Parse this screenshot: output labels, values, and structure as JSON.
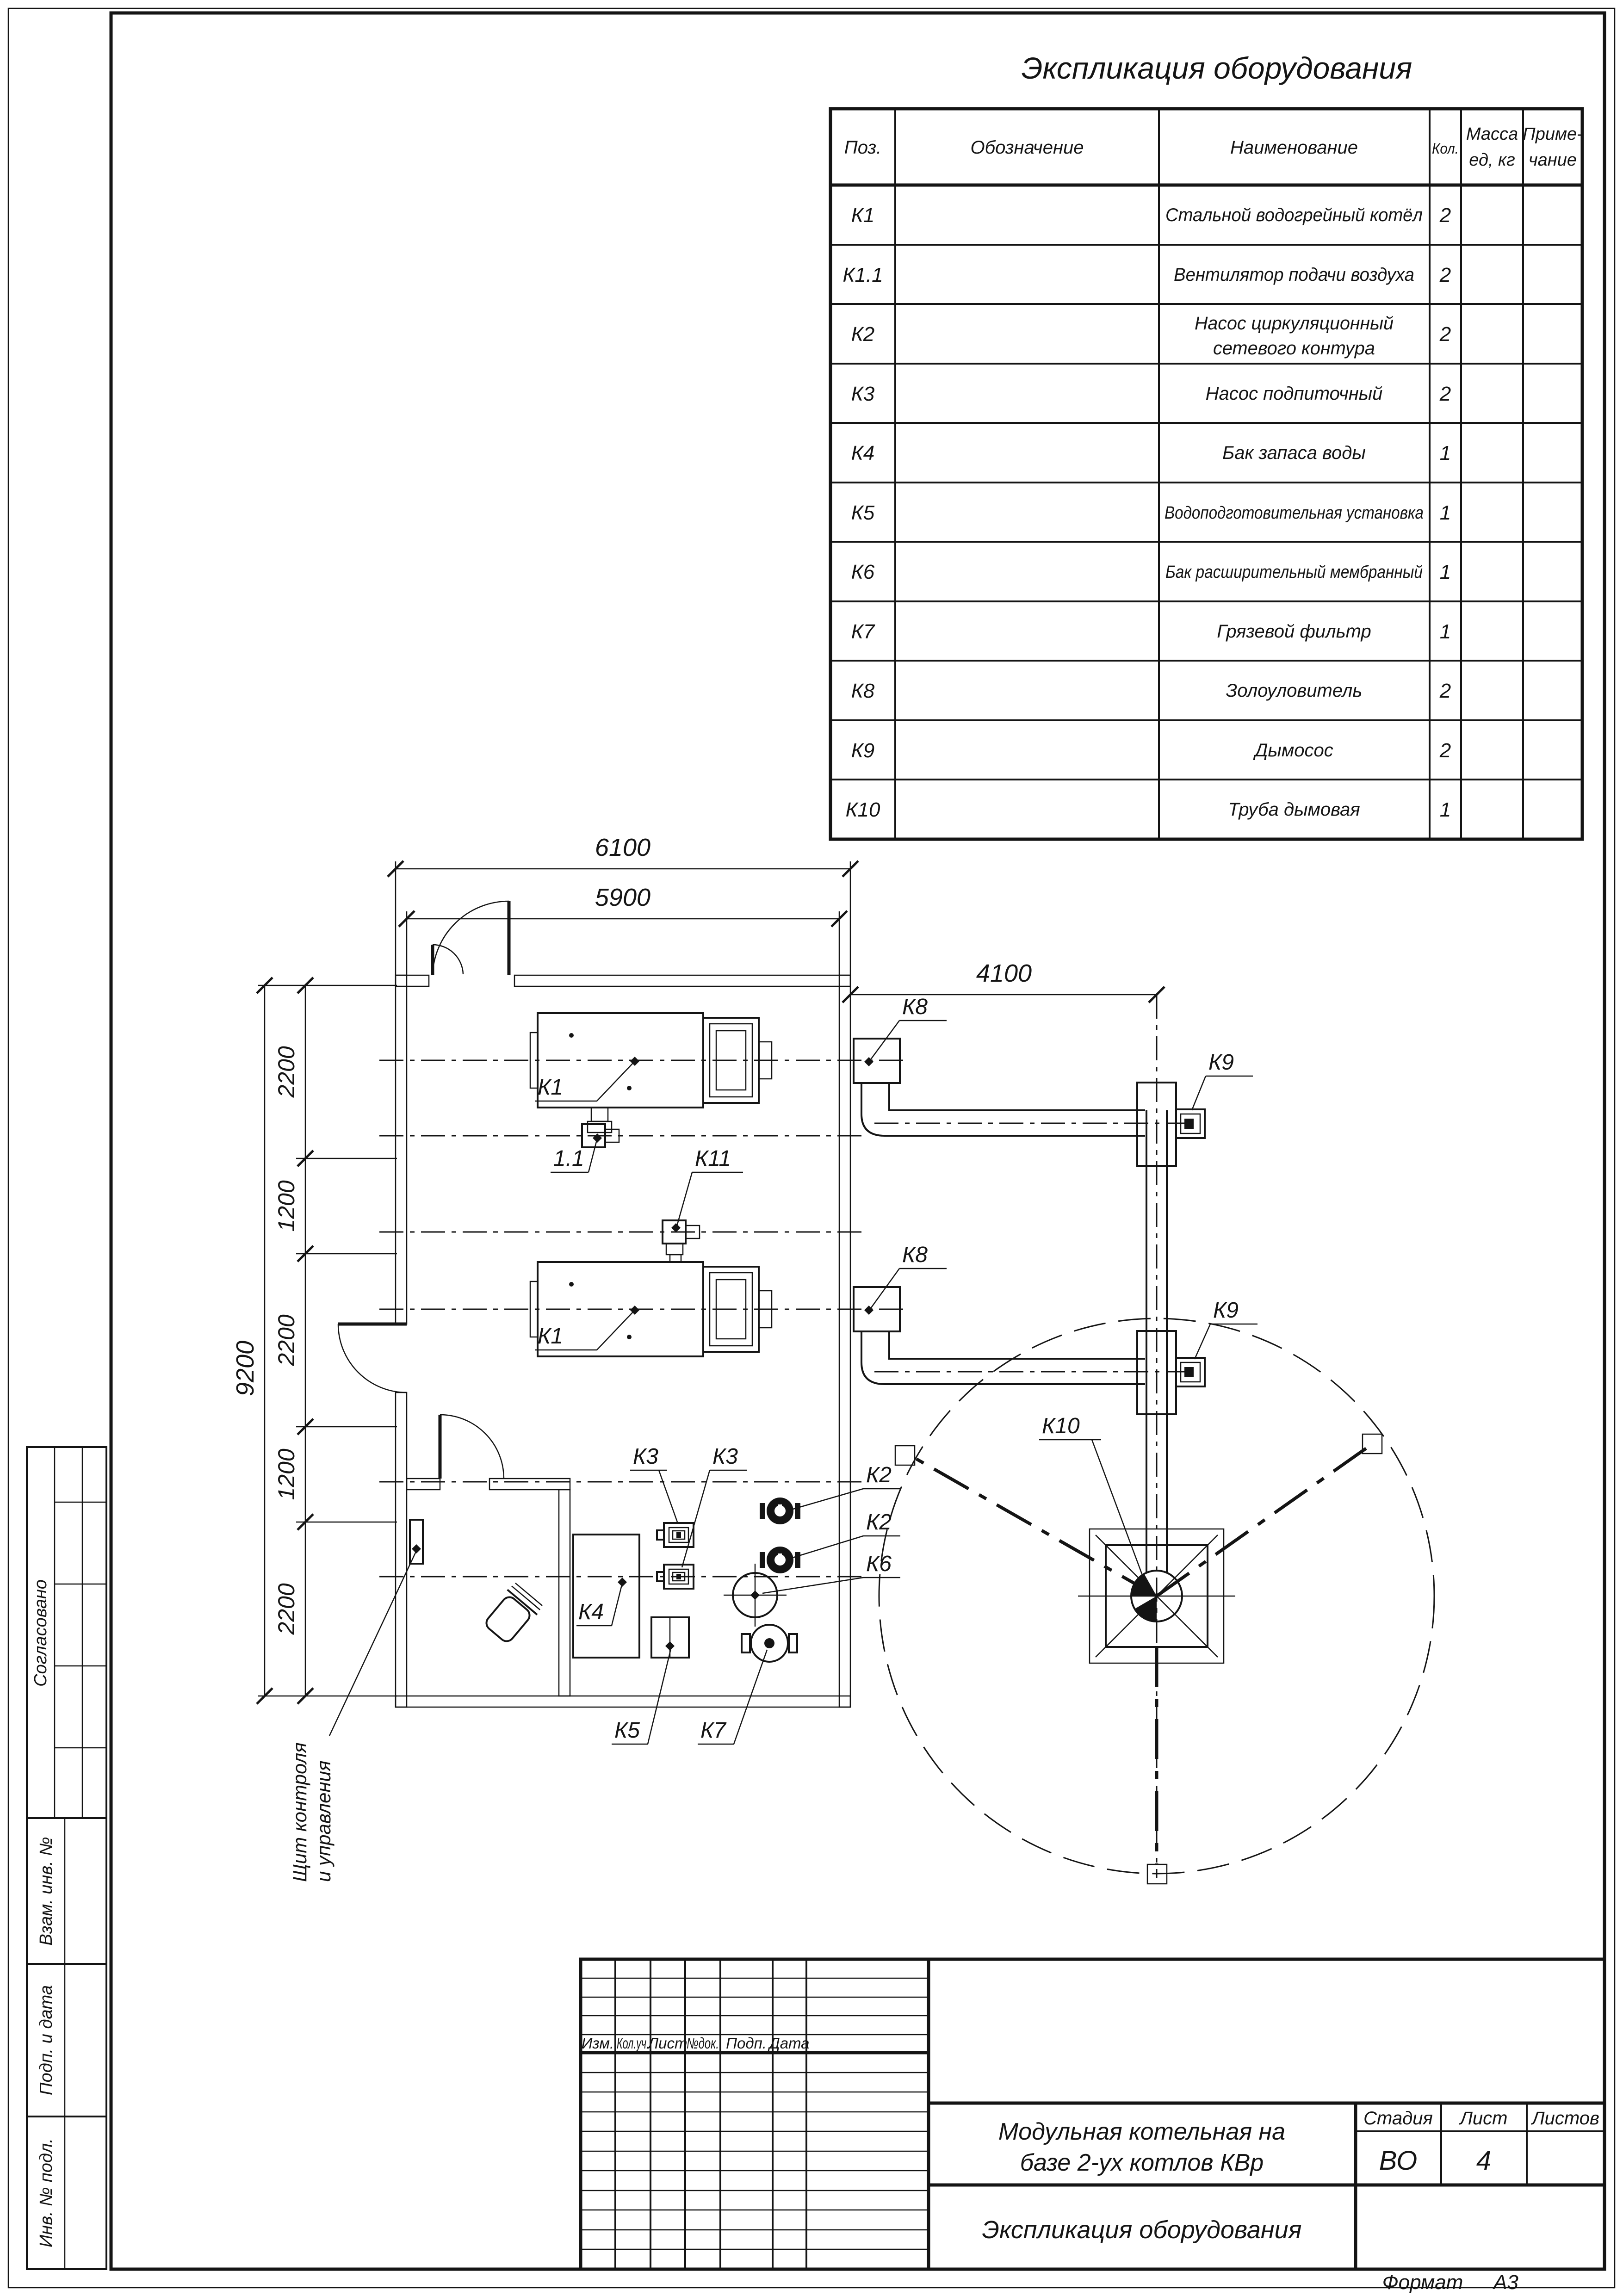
{
  "sheet": {
    "format_label": "Формат",
    "format_value": "А3"
  },
  "equipment_table": {
    "title": "Экспликация оборудования",
    "headers": {
      "pos": "Поз.",
      "designation": "Обозначение",
      "name": "Наименование",
      "qty": "Кол.",
      "mass_l1": "Масса",
      "mass_l2": "ед, кг",
      "note_l1": "Приме-",
      "note_l2": "чание"
    },
    "rows": [
      {
        "pos": "К1",
        "name": "Стальной водогрейный котёл",
        "name2": "",
        "qty": "2"
      },
      {
        "pos": "К1.1",
        "name": "Вентилятор подачи воздуха",
        "name2": "",
        "qty": "2"
      },
      {
        "pos": "К2",
        "name": "Насос циркуляционный",
        "name2": "сетевого контура",
        "qty": "2"
      },
      {
        "pos": "К3",
        "name": "Насос подпиточный",
        "name2": "",
        "qty": "2"
      },
      {
        "pos": "К4",
        "name": "Бак запаса воды",
        "name2": "",
        "qty": "1"
      },
      {
        "pos": "К5",
        "name": "Водоподготовительная установка",
        "name2": "",
        "qty": "1"
      },
      {
        "pos": "К6",
        "name": "Бак расширительный мембранный",
        "name2": "",
        "qty": "1"
      },
      {
        "pos": "К7",
        "name": "Грязевой фильтр",
        "name2": "",
        "qty": "1"
      },
      {
        "pos": "К8",
        "name": "Золоуловитель",
        "name2": "",
        "qty": "2"
      },
      {
        "pos": "К9",
        "name": "Дымосос",
        "name2": "",
        "qty": "2"
      },
      {
        "pos": "К10",
        "name": "Труба дымовая",
        "name2": "",
        "qty": "1"
      }
    ]
  },
  "title_block": {
    "rev_headers": [
      "Изм.",
      "Кол.уч.",
      "Лист",
      "№док.",
      "Подп.",
      "Дата"
    ],
    "project_l1": "Модульная котельная на",
    "project_l2": "базе 2-ух котлов КВр",
    "stage_label": "Стадия",
    "sheet_label": "Лист",
    "sheets_label": "Листов",
    "stage_value": "ВО",
    "sheet_value": "4",
    "sheet_title": "Экспликация оборудования"
  },
  "side_stamps": {
    "approved": "Согласовано",
    "replace_inv": "Взам. инв. №",
    "sign_date": "Подп. и дата",
    "inv_no": "Инв. № подл."
  },
  "plan": {
    "dims": {
      "width_outer": "6100",
      "width_inner": "5900",
      "duct_run": "4100",
      "height_overall": "9200",
      "seg1": "2200",
      "seg2": "1200",
      "seg3": "2200",
      "seg4": "1200",
      "seg5": "2200"
    },
    "labels": {
      "k1_top": "К1",
      "k1_bottom": "К1",
      "fan_top": "1.1",
      "fan_bottom": "К11",
      "k8_top": "К8",
      "k8_bottom": "К8",
      "k9_top": "К9",
      "k9_bottom": "К9",
      "k10": "К10",
      "k2_top": "К2",
      "k2_bottom": "К2",
      "k3_left": "К3",
      "k3_right": "К3",
      "k4": "К4",
      "k5": "К5",
      "k6": "К6",
      "k7": "К7",
      "panel_l1": "Щит контроля",
      "panel_l2": "и управления"
    }
  }
}
